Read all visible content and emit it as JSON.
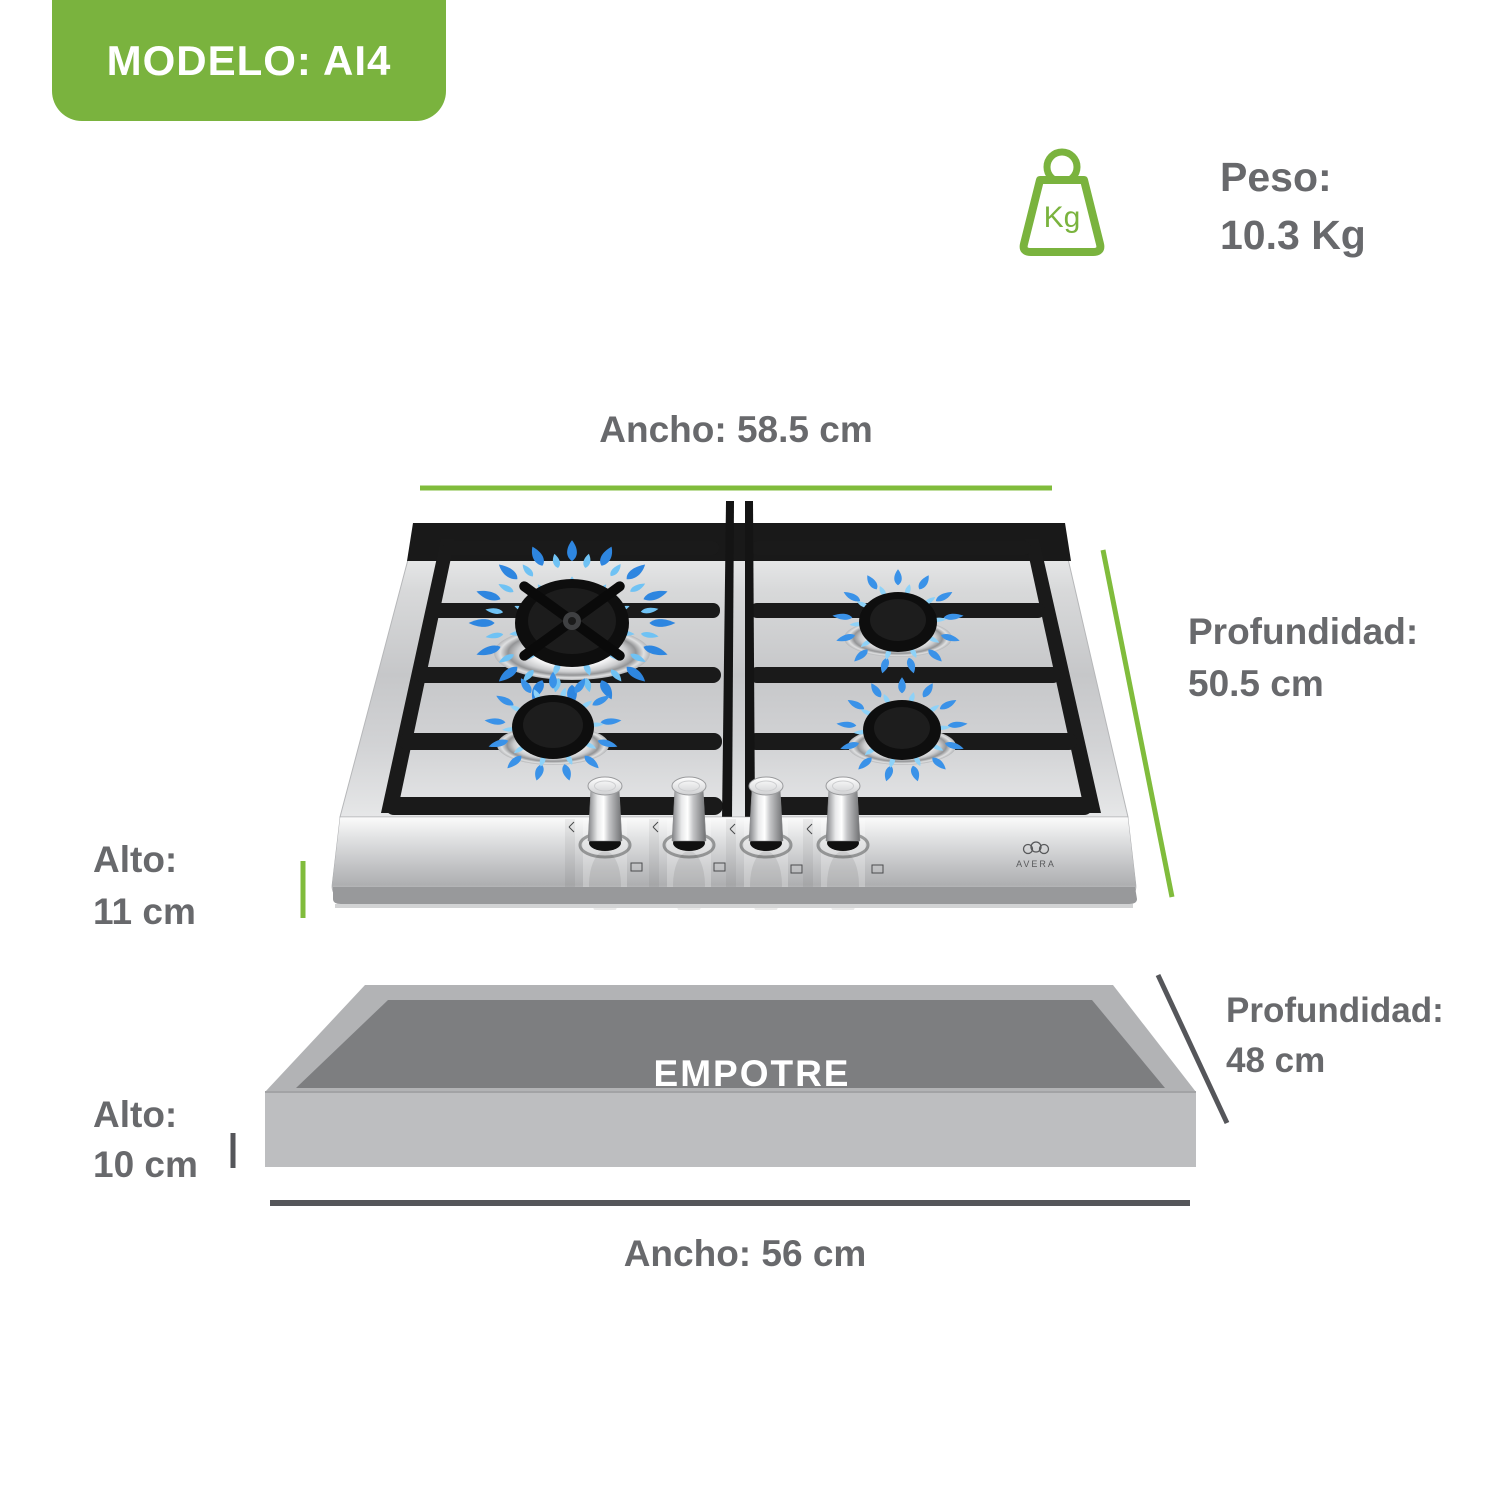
{
  "title_badge": {
    "label": "MODELO: AI4"
  },
  "weight": {
    "label": "Peso:",
    "value": "10.3 Kg",
    "icon_text": "Kg"
  },
  "dimensions": {
    "width_top": "Ancho: 58.5 cm",
    "depth_top_1": "Profundidad:",
    "depth_top_2": "50.5 cm",
    "height_top_1": "Alto:",
    "height_top_2": "11 cm",
    "depth_cutout_1": "Profundidad:",
    "depth_cutout_2": "48 cm",
    "height_cutout_1": "Alto:",
    "height_cutout_2": "10 cm",
    "width_cutout": "Ancho: 56 cm"
  },
  "cutout": {
    "label": "EMPOTRE"
  },
  "cooktop": {
    "brand": "AVERA",
    "burner_count": 4,
    "knob_count": 4
  },
  "colors": {
    "accent_green": "#7AB33E",
    "line_green": "#80BC3C",
    "text_gray": "#68696C",
    "line_dark": "#55565A",
    "flame_blue": "#3A92E8",
    "cutout_dark": "#7D7E80",
    "cutout_light": "#B3B4B6"
  }
}
